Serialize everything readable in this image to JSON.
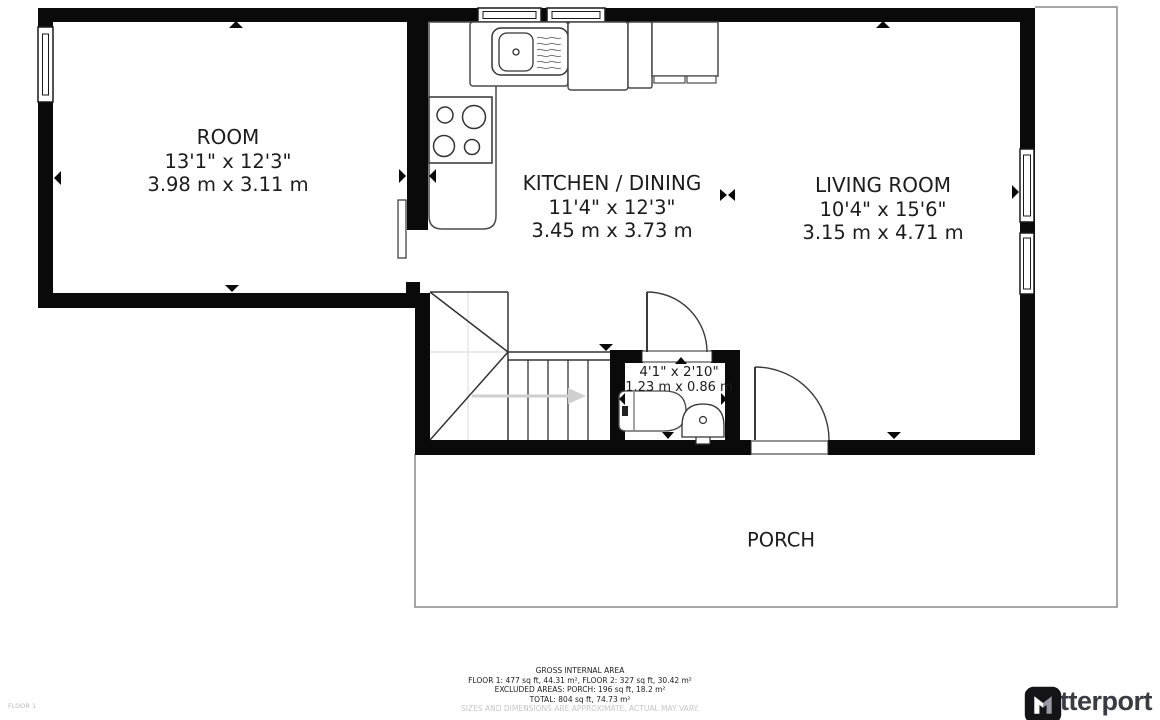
{
  "rooms": {
    "room": {
      "name": "ROOM",
      "imperial": "13'1\" x 12'3\"",
      "metric": "3.98 m x 3.11 m"
    },
    "kitchen": {
      "name": "KITCHEN / DINING",
      "imperial": "11'4\" x 12'3\"",
      "metric": "3.45 m x 3.73 m"
    },
    "living": {
      "name": "LIVING ROOM",
      "imperial": "10'4\" x 15'6\"",
      "metric": "3.15 m x 4.71 m"
    },
    "wc": {
      "imperial": "4'1\" x 2'10\"",
      "metric": "1.23 m x 0.86 m"
    },
    "porch": {
      "name": "PORCH"
    }
  },
  "footer": {
    "title": "GROSS INTERNAL AREA",
    "floors": "FLOOR 1: 477 sq ft, 44.31 m², FLOOR 2: 327 sq ft, 30.42 m²",
    "excluded": "EXCLUDED AREAS: PORCH: 196 sq ft, 18.2 m²",
    "total": "TOTAL: 804 sq ft, 74.73 m²",
    "disclaimer": "SIZES AND DIMENSIONS ARE APPROXIMATE, ACTUAL MAY VARY."
  },
  "floor_label": "FLOOR 1",
  "brand": {
    "name": "Matterport"
  },
  "colors": {
    "wall": "#0a0a0a",
    "fixture_line": "#4a4a4a",
    "faint": "#c6c6c6",
    "logo_bg": "#131318",
    "logo_text": "#3b3b44"
  }
}
